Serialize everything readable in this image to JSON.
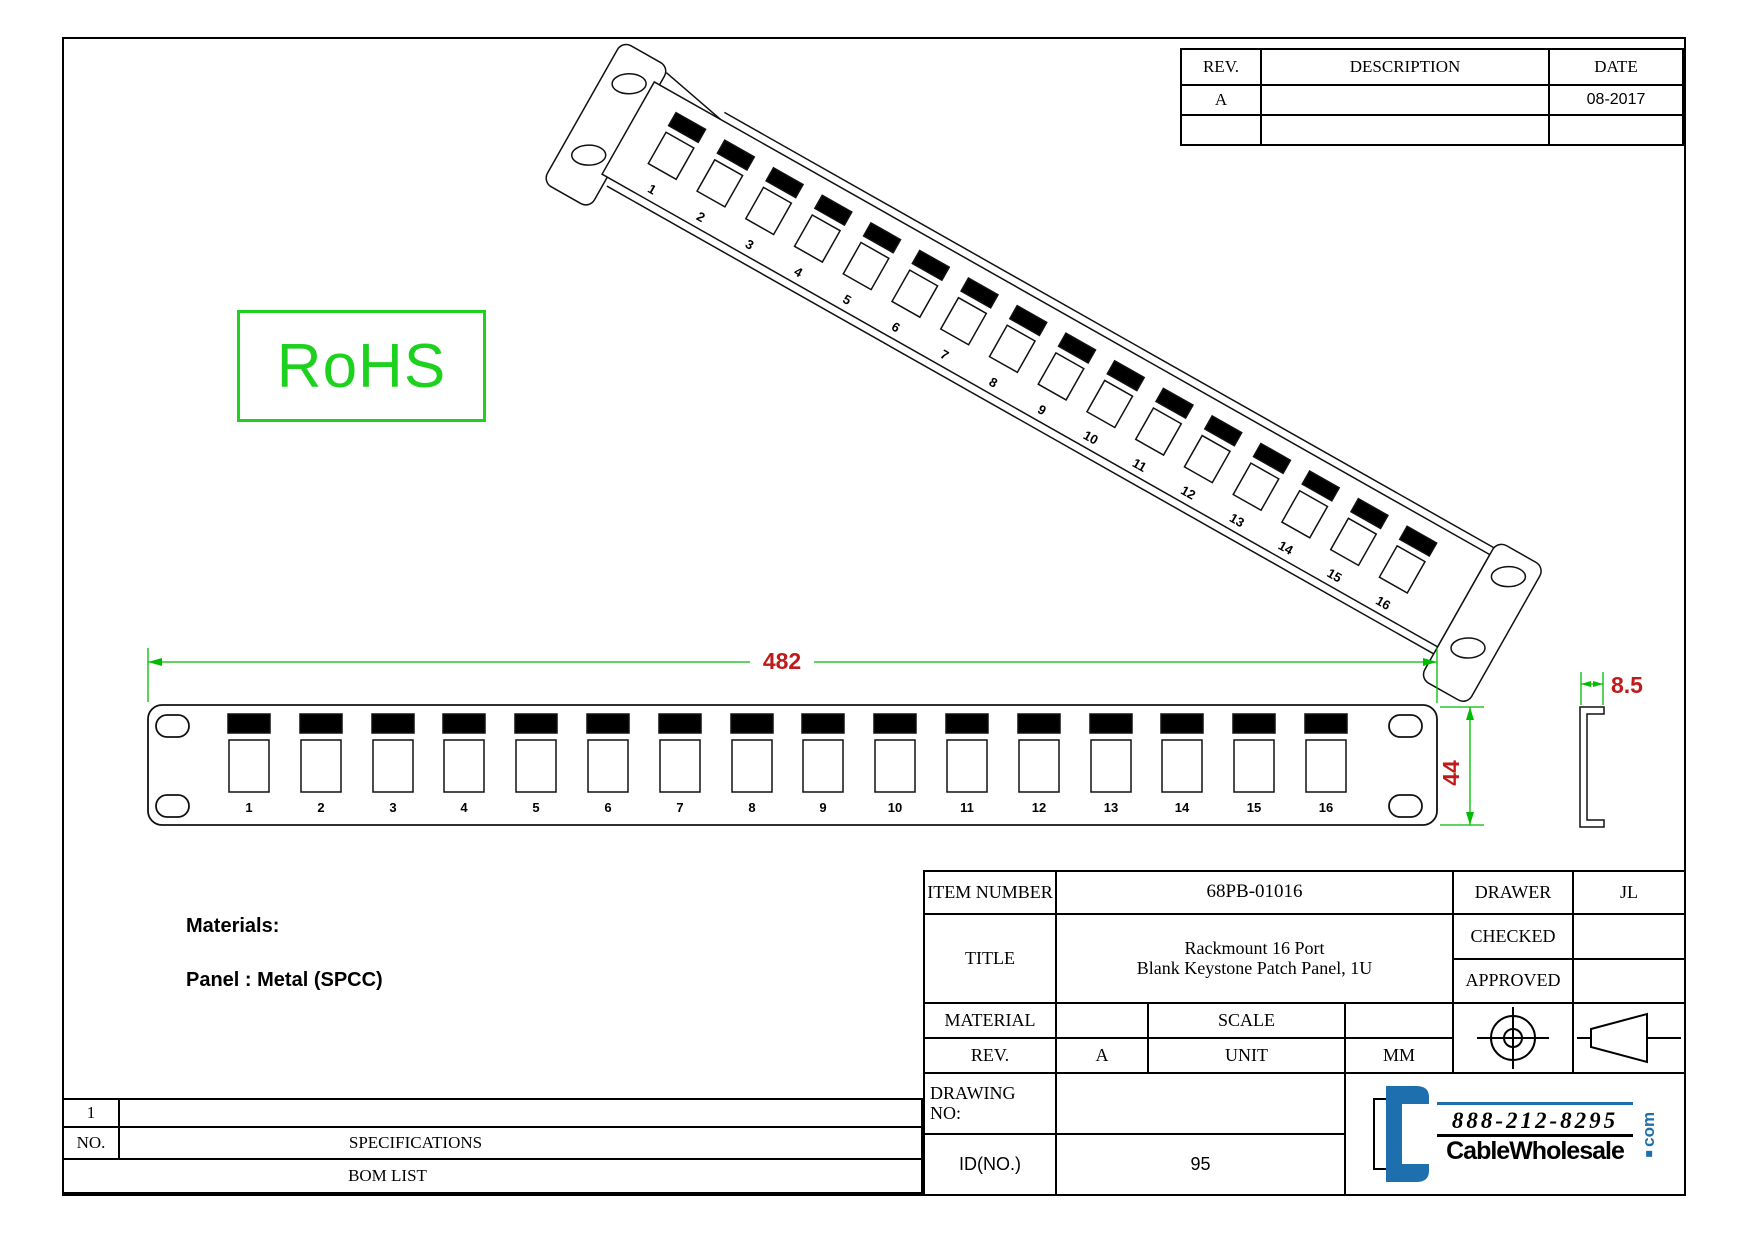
{
  "colors": {
    "line": "#111111",
    "dimension_green": "#00bb00",
    "dimension_red": "#c01a1a",
    "rohs_green": "#1fd11f",
    "logo_blue": "#1d6fad"
  },
  "revision_table": {
    "headers": {
      "rev": "REV.",
      "description": "DESCRIPTION",
      "date": "DATE"
    },
    "rows": [
      {
        "rev": "A",
        "description": "",
        "date": "08-2017"
      },
      {
        "rev": "",
        "description": "",
        "date": ""
      }
    ]
  },
  "rohs": {
    "label": "RoHS"
  },
  "materials": {
    "line1": "Materials:",
    "line2": "Panel : Metal (SPCC)"
  },
  "dimensions": {
    "width": "482",
    "height": "44",
    "depth": "8.5"
  },
  "iso_view": {
    "ports": [
      "1",
      "2",
      "3",
      "4",
      "5",
      "6",
      "7",
      "8",
      "9",
      "10",
      "11",
      "12",
      "13",
      "14",
      "15",
      "16"
    ]
  },
  "front_view": {
    "ports": [
      "1",
      "2",
      "3",
      "4",
      "5",
      "6",
      "7",
      "8",
      "9",
      "10",
      "11",
      "12",
      "13",
      "14",
      "15",
      "16"
    ]
  },
  "title_block": {
    "item_number_label": "ITEM NUMBER",
    "item_number": "68PB-01016",
    "drawer_label": "DRAWER",
    "drawer": "JL",
    "title_label": "TITLE",
    "title_line1": "Rackmount 16 Port",
    "title_line2": "Blank Keystone Patch Panel, 1U",
    "checked_label": "CHECKED",
    "checked": "",
    "approved_label": "APPROVED",
    "approved": "",
    "material_label": "MATERIAL",
    "material": "",
    "scale_label": "SCALE",
    "scale": "",
    "rev_label": "REV.",
    "rev": "A",
    "unit_label": "UNIT",
    "unit": "MM",
    "drawing_no_label": "DRAWING NO:",
    "drawing_no": "",
    "id_label": "ID(NO.)",
    "id": "95"
  },
  "bom": {
    "no_header": "NO.",
    "spec_header": "SPECIFICATIONS",
    "footer": "BOM LIST",
    "rows": [
      {
        "no": "1",
        "spec": ""
      }
    ]
  },
  "logo": {
    "phone": "888-212-8295",
    "name": "CableWholesale",
    "tld": "com"
  }
}
